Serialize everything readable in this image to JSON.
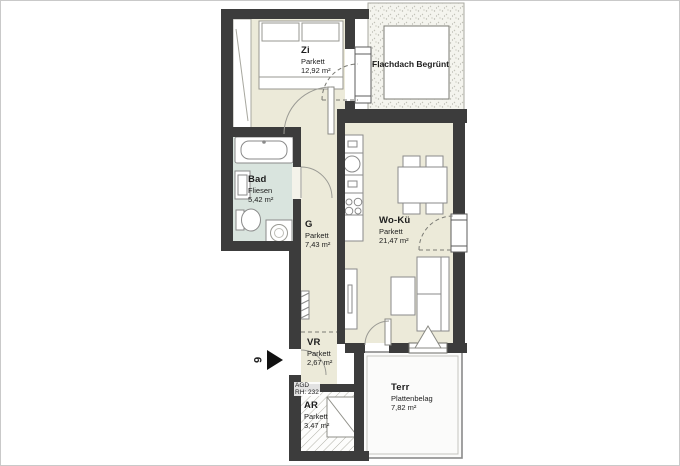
{
  "plan": {
    "title": "floor-plan",
    "rooms": [
      {
        "id": "zi",
        "name": "Zi",
        "floor": "Parkett",
        "area": "12,92 m²"
      },
      {
        "id": "bad",
        "name": "Bad",
        "floor": "Fliesen",
        "area": "5,42 m²"
      },
      {
        "id": "g",
        "name": "G",
        "floor": "Parkett",
        "area": "7,43 m²"
      },
      {
        "id": "woku",
        "name": "Wo-Kü",
        "floor": "Parkett",
        "area": "21,47 m²"
      },
      {
        "id": "vr",
        "name": "VR",
        "floor": "Parkett",
        "area": "2,67 m²"
      },
      {
        "id": "ar",
        "name": "AR",
        "floor": "Parkett",
        "area": "3,47 m²"
      },
      {
        "id": "terr",
        "name": "Terr",
        "floor": "Plattenbelag",
        "area": "7,82 m²"
      }
    ],
    "roof_label": "Flachdach Begrünt",
    "annotation": {
      "line1": "AGD",
      "line2": "RH: 232"
    },
    "unit_marker": {
      "number": "6"
    },
    "colors": {
      "wall": "#3c3c3c",
      "parquet_floor": "#ecead9",
      "tile_floor": "#d9e4de",
      "fixture_outline": "#8a8a8a",
      "roof_fill": "#f4f4ee",
      "terrace_fill": "#fbfbfa"
    }
  }
}
